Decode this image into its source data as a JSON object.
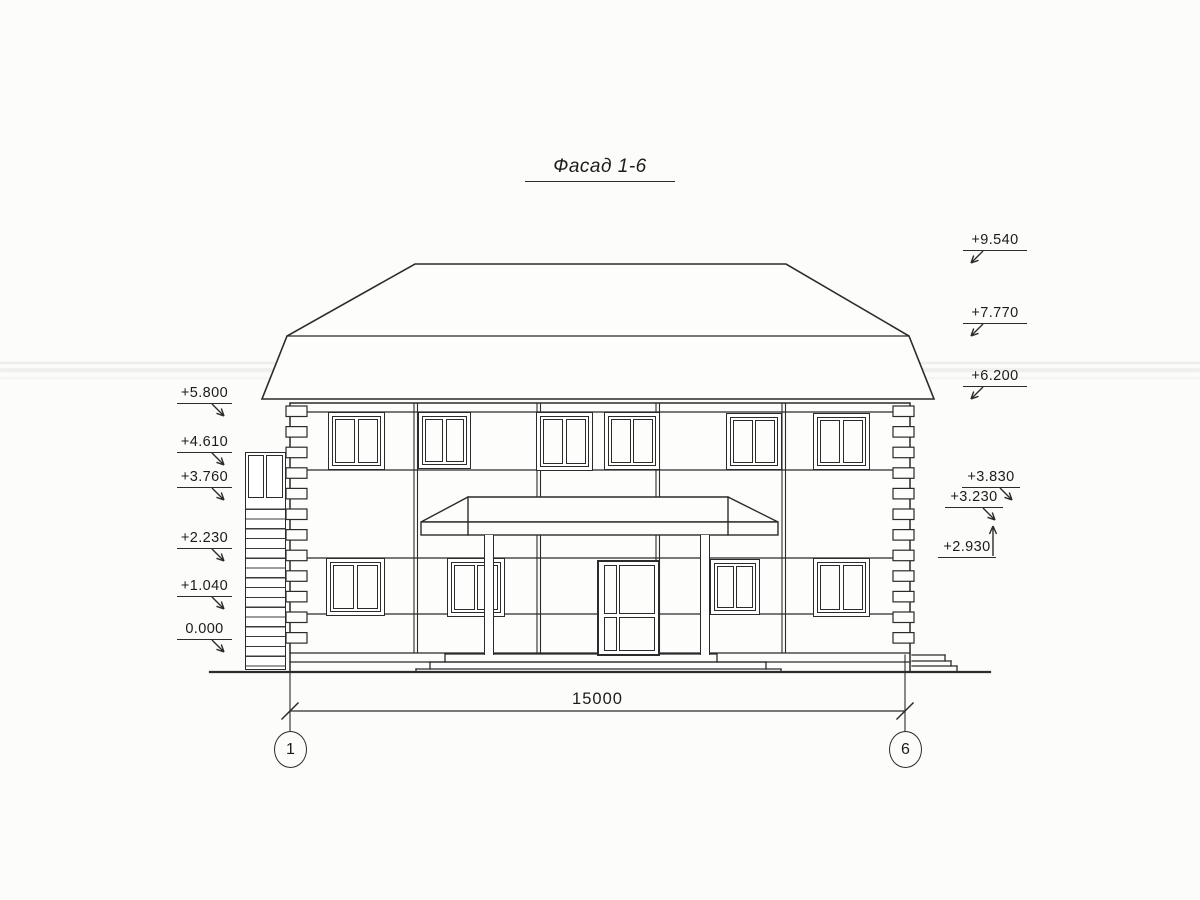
{
  "title": "Фасад 1-6",
  "marks": {
    "left": [
      {
        "label": "+5.800"
      },
      {
        "label": "+4.610"
      },
      {
        "label": "+3.760"
      },
      {
        "label": "+2.230"
      },
      {
        "label": "+1.040"
      },
      {
        "label": "0.000"
      }
    ],
    "right_upper": [
      {
        "label": "+9.540"
      },
      {
        "label": "+7.770"
      },
      {
        "label": "+6.200"
      }
    ],
    "right_lower": [
      {
        "label": "+3.830"
      },
      {
        "label": "+3.230"
      },
      {
        "label": "+2.930"
      }
    ]
  },
  "dimension": {
    "value": "15000"
  },
  "axes": {
    "left": "1",
    "right": "6"
  },
  "colors": {
    "line": "#2b2b2b",
    "paper": "#fcfcfb"
  }
}
